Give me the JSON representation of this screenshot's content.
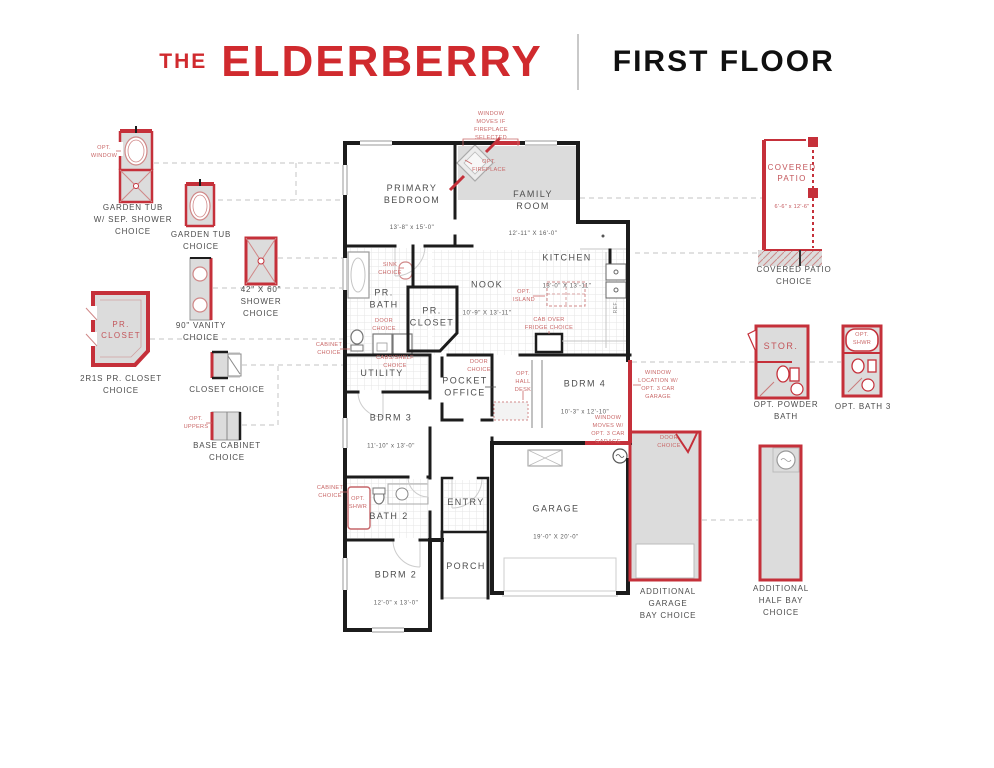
{
  "header": {
    "brand_prefix": "THE",
    "brand_name": "ELDERBERRY",
    "page_title": "FIRST FLOOR"
  },
  "rooms": {
    "primary_bedroom": {
      "name": "PRIMARY\nBEDROOM",
      "dim": "13'-8\" x 15'-0\""
    },
    "family_room": {
      "name": "FAMILY\nROOM",
      "dim": "12'-11\" X 16'-0\""
    },
    "kitchen": {
      "name": "KITCHEN",
      "dim": "13'-0\" X 13'-11\""
    },
    "nook": {
      "name": "NOOK",
      "dim": "10'-9\" X 13'-11\""
    },
    "pr_bath": {
      "name": "PR.\nBATH"
    },
    "pr_closet": {
      "name": "PR.\nCLOSET"
    },
    "utility": {
      "name": "UTILITY"
    },
    "pocket_office": {
      "name": "POCKET\nOFFICE"
    },
    "bdrm4": {
      "name": "BDRM 4",
      "dim": "10'-3\" x 12'-10\""
    },
    "bdrm3": {
      "name": "BDRM 3",
      "dim": "11'-10\" x 13'-0\""
    },
    "bath2": {
      "name": "BATH 2"
    },
    "bdrm2": {
      "name": "BDRM 2",
      "dim": "12'-0\" x 13'-0\""
    },
    "entry": {
      "name": "ENTRY"
    },
    "porch": {
      "name": "PORCH"
    },
    "garage": {
      "name": "GARAGE",
      "dim": "19'-0\" X 20'-0\""
    },
    "ref": {
      "name": "REF."
    }
  },
  "annotations": {
    "window_moves_fireplace": "WINDOW\nMOVES IF\nFIREPLACE\nSELECTED",
    "opt_fireplace": "OPT.\nFIREPLACE",
    "sink_choice": "SINK\nCHOICE",
    "door_choice_bath": "DOOR\nCHOICE",
    "cabinet_choice_utility": "CABINET\nCHOICE",
    "cabs_shelf_choice": "CABS/SHELF\nCHOICE",
    "opt_island": "OPT.\nISLAND",
    "cab_over_fridge": "CAB OVER\nFRIDGE CHOICE",
    "door_choice_office": "DOOR\nCHOICE",
    "opt_hall_desk": "OPT.\nHALL\nDESK",
    "window_location_garage": "WINDOW\nLOCATION W/\nOPT. 3 CAR\nGARAGE",
    "window_moves_garage": "WINDOW\nMOVES W/\nOPT. 3 CAR\nGARAGE",
    "door_choice_garage": "DOOR\nCHOICE",
    "cabinet_choice_bath2": "CABINET\nCHOICE",
    "opt_shwr_bath2": "OPT.\nSHWR"
  },
  "left_options": {
    "opt_window": "OPT.\nWINDOW",
    "garden_tub_sep_shower": "GARDEN TUB\nW/ SEP. SHOWER\nCHOICE",
    "garden_tub": "GARDEN TUB\nCHOICE",
    "shower_42x60": "42\" X 60\"\nSHOWER\nCHOICE",
    "vanity_90": "90\" VANITY\nCHOICE",
    "pr_closet_inner": "PR.\nCLOSET",
    "pr_closet_2r1s": "2R1S PR. CLOSET\nCHOICE",
    "closet": "CLOSET CHOICE",
    "opt_uppers": "OPT.\nUPPERS",
    "base_cabinet": "BASE CABINET\nCHOICE"
  },
  "right_options": {
    "covered_patio_inner": "COVERED\nPATIO",
    "covered_patio_dim": "6'-6\" x 12'-6\"",
    "covered_patio": "COVERED PATIO\nCHOICE",
    "stor": "STOR.",
    "powder_bath": "OPT. POWDER\nBATH",
    "opt_shwr_bath3": "OPT.\nSHWR",
    "bath3": "OPT. BATH 3",
    "additional_garage_bay": "ADDITIONAL\nGARAGE\nBAY CHOICE",
    "additional_half_bay": "ADDITIONAL\nHALF BAY\nCHOICE"
  },
  "colors": {
    "accent_red": "#d02a2e",
    "wall_black": "#1c1c1c",
    "option_red": "#c5303a",
    "fill_gray": "#dcdcdc",
    "note_red": "#c96868"
  }
}
